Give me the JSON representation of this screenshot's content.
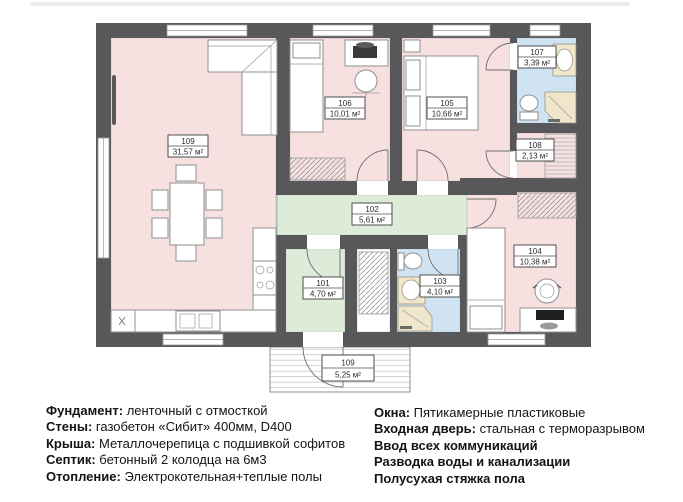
{
  "plan": {
    "title": "house-floor-plan",
    "rooms": [
      {
        "number": "109",
        "area": "31,57 м²",
        "name": "living-kitchen",
        "fill": "#f7e0e0"
      },
      {
        "number": "106",
        "area": "10,01 м²",
        "name": "bedroom-106",
        "fill": "#f7e0e0"
      },
      {
        "number": "105",
        "area": "10,66 м²",
        "name": "bedroom-105",
        "fill": "#f7e0e0"
      },
      {
        "number": "107",
        "area": "3,39 м²",
        "name": "bathroom-107",
        "fill": "#cfe3f2"
      },
      {
        "number": "108",
        "area": "2,13 м²",
        "name": "closet-108",
        "fill": "#f7e0e0"
      },
      {
        "number": "102",
        "area": "5,61 м²",
        "name": "hallway-102",
        "fill": "#dcecd9"
      },
      {
        "number": "101",
        "area": "4,70 м²",
        "name": "entry-101",
        "fill": "#dcecd9"
      },
      {
        "number": "103",
        "area": "4,10 м²",
        "name": "bathroom-103",
        "fill": "#cfe3f2"
      },
      {
        "number": "104",
        "area": "10,38 м²",
        "name": "bedroom-104",
        "fill": "#f7e0e0"
      },
      {
        "number": "109",
        "area": "5,25 м²",
        "name": "porch-terrace",
        "fill": "#ffffff"
      }
    ],
    "icons": [
      "corner-sofa-icon",
      "dining-table-icon",
      "chair-icon",
      "tv-icon",
      "kitchen-sink-icon",
      "stove-icon",
      "single-bed-icon",
      "double-bed-icon",
      "desk-icon",
      "office-chair-icon",
      "toilet-icon",
      "wash-basin-icon",
      "corner-shower-icon",
      "wardrobe-hatch-icon",
      "laptop-icon",
      "pot-icon"
    ],
    "colors": {
      "wall": "#58585a",
      "room_pink": "#f7e0e0",
      "room_green": "#dcecd9",
      "room_blue": "#cfe3f2",
      "fixture_tan": "#efe6cb"
    }
  },
  "specs_left": [
    {
      "label": "Фундамент:",
      "value": "ленточный с отмосткой"
    },
    {
      "label": "Стены:",
      "value": "газобетон «Сибит» 400мм, D400"
    },
    {
      "label": "Крыша:",
      "value": "Металлочерепица с подшивкой софитов"
    },
    {
      "label": "Септик:",
      "value": "бетонный 2 колодца на 6м3"
    },
    {
      "label": "Отопление:",
      "value": "Электрокотельная+теплые полы"
    }
  ],
  "specs_right": [
    {
      "label": "Окна:",
      "value": "Пятикамерные пластиковые"
    },
    {
      "label": "Входная дверь:",
      "value": "стальная с терморазрывом"
    },
    {
      "label": "Ввод всех коммуникаций",
      "value": ""
    },
    {
      "label": "Разводка воды и канализации",
      "value": ""
    },
    {
      "label": "Полусухая стяжка пола",
      "value": ""
    }
  ]
}
